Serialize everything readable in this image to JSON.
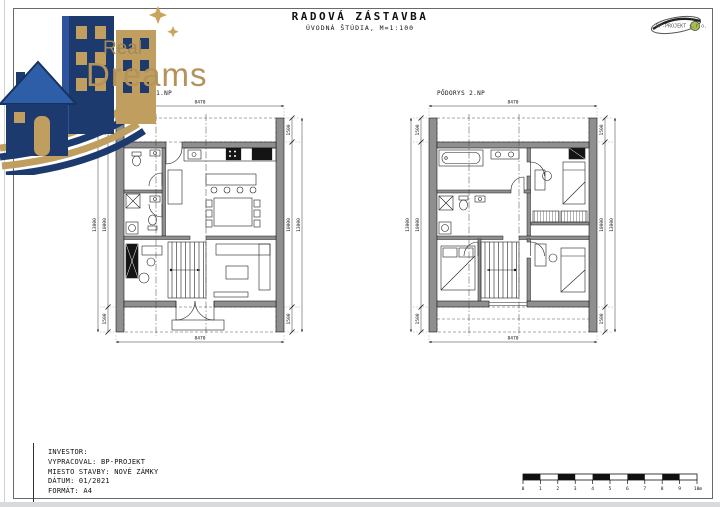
{
  "page": {
    "title": "RADOVÁ ZÁSTAVBA",
    "subtitle": "ÚVODNÁ ŠTÚDIA, M=1:100"
  },
  "brand": {
    "name_top": "Real",
    "name_bottom": "Dreams",
    "gold": "#b3935a",
    "navy": "#1c3a6e"
  },
  "corner_logo": {
    "text": "BP-PROJEKT s.r.o."
  },
  "plans": [
    {
      "title": "PÔDORYS 1.NP",
      "dim_width": "8470",
      "dim_total": "13000",
      "dim_seg_top": "1500",
      "dim_seg_mid": "10000",
      "dim_seg_bottom": "1500"
    },
    {
      "title": "PÔDORYS 2.NP",
      "dim_width": "8470",
      "dim_total": "13000",
      "dim_seg_top": "1500",
      "dim_seg_mid": "10000",
      "dim_seg_bottom": "1500"
    }
  ],
  "title_block": {
    "rows": [
      "INVESTOR:",
      "VYPRACOVAL: BP-PROJEKT",
      "MIESTO STAVBY: NOVÉ ZÁMKY",
      "DÁTUM: 01/2021",
      "FORMÁT: A4"
    ]
  },
  "scale_bar": {
    "labels": [
      "0",
      "1",
      "2",
      "3",
      "4",
      "5",
      "6",
      "7",
      "8",
      "9",
      "10m"
    ]
  }
}
